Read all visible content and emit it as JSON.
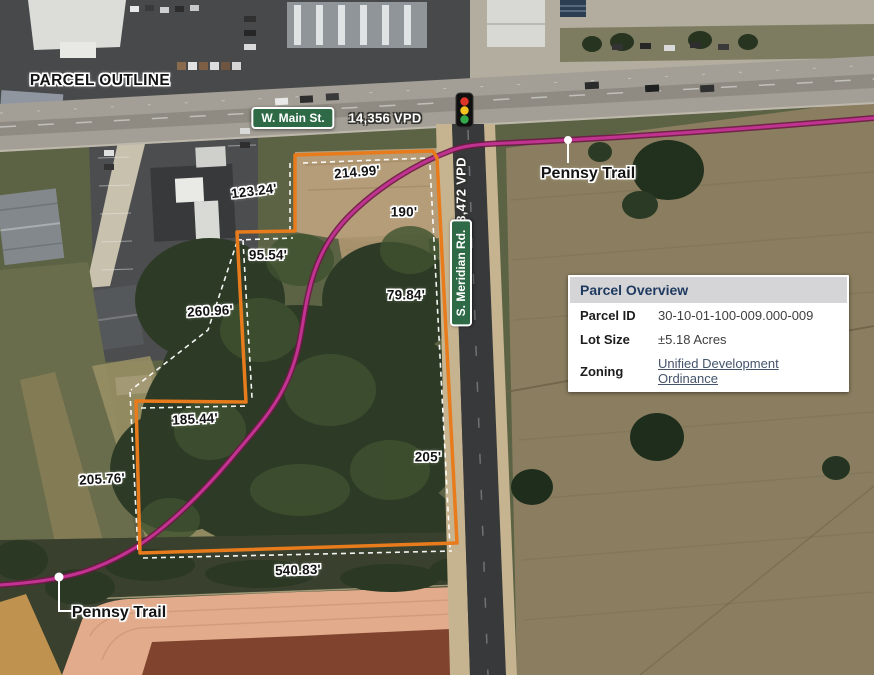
{
  "map": {
    "title": "PARCEL OUTLINE",
    "roads": {
      "main_st": "W. Main St.",
      "meridian_rd": "S. Meridian Rd."
    },
    "traffic": {
      "main_vpd": "14,356 VPD",
      "meridian_vpd": "3,472 VPD"
    },
    "trail_labels": [
      "Pennsy Trail",
      "Pennsy Trail"
    ],
    "dimensions": [
      {
        "value": "123.24'"
      },
      {
        "value": "214.99'"
      },
      {
        "value": "190'"
      },
      {
        "value": "95.54'"
      },
      {
        "value": "79.84'"
      },
      {
        "value": "260.96'"
      },
      {
        "value": "185.44'"
      },
      {
        "value": "205.76'"
      },
      {
        "value": "205'"
      },
      {
        "value": "540.83'"
      }
    ]
  },
  "parcel_overview": {
    "title": "Parcel Overview",
    "rows": [
      {
        "label": "Parcel ID",
        "value": "30-10-01-100-009.000-009"
      },
      {
        "label": "Lot Size",
        "value": "±5.18 Acres"
      },
      {
        "label": "Zoning",
        "value": "Unified Development Ordinance"
      }
    ]
  },
  "icons": {
    "traffic_light": "traffic-light-icon",
    "trail_marker": "trail-dot-icon"
  },
  "colors": {
    "parcel_outline": "#e87b1c",
    "trail": "#c13390",
    "road_sign_green": "#2d6a45",
    "table_header_text": "#1e3a5f",
    "link": "#44546a"
  }
}
